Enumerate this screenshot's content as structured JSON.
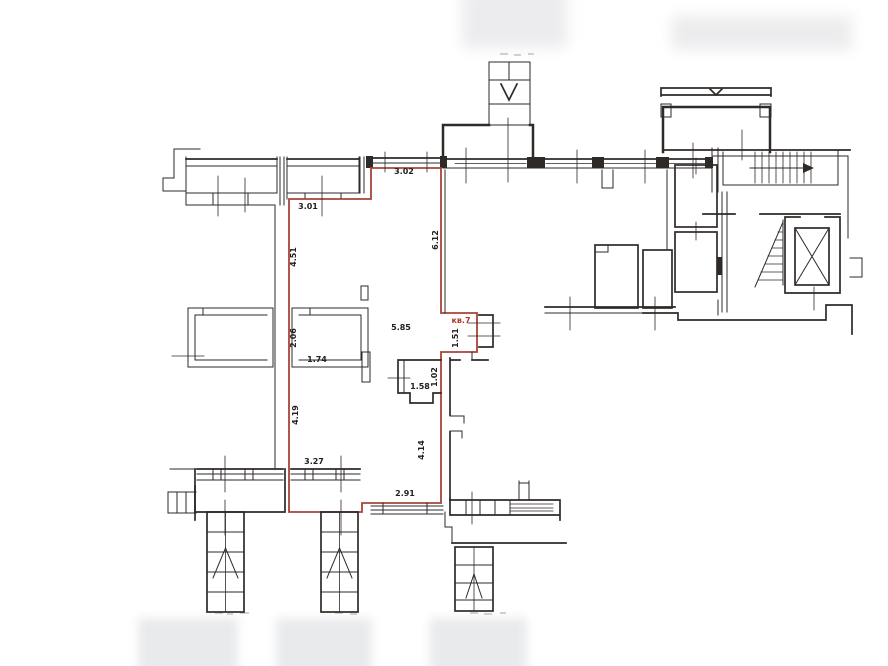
{
  "plan": {
    "apartment_label": "кв.7",
    "colors": {
      "walls": "#2e2a28",
      "apartment_outline": "#a84438",
      "apartment_label_color": "#b43527",
      "background": "#ffffff",
      "scan_artifact": "#ebecee"
    },
    "labels": [
      {
        "name": "dim-top-window",
        "text": "3.02",
        "x": 404,
        "y": 174,
        "rot": 0,
        "accent": false
      },
      {
        "name": "dim-upper-left-wall",
        "text": "3.01",
        "x": 308,
        "y": 209,
        "rot": 0,
        "accent": false
      },
      {
        "name": "dim-west-wall-upper",
        "text": "4.51",
        "x": 296,
        "y": 257,
        "rot": -90,
        "accent": false
      },
      {
        "name": "dim-east-wall",
        "text": "6.12",
        "x": 438,
        "y": 240,
        "rot": -90,
        "accent": false
      },
      {
        "name": "dim-room-width",
        "text": "5.85",
        "x": 401,
        "y": 330,
        "rot": 0,
        "accent": false
      },
      {
        "name": "apartment-number",
        "text": "кв.7",
        "x": 461,
        "y": 323,
        "rot": 0,
        "accent": true
      },
      {
        "name": "dim-entry-niche",
        "text": "1.51",
        "x": 458,
        "y": 338,
        "rot": -90,
        "accent": false
      },
      {
        "name": "dim-closet-depth",
        "text": "2.06",
        "x": 296,
        "y": 338,
        "rot": -90,
        "accent": false
      },
      {
        "name": "dim-closet-width",
        "text": "1.74",
        "x": 317,
        "y": 362,
        "rot": 0,
        "accent": false
      },
      {
        "name": "dim-bath-depth",
        "text": "1.02",
        "x": 437,
        "y": 377,
        "rot": -90,
        "accent": false
      },
      {
        "name": "dim-bath-width",
        "text": "1.58",
        "x": 420,
        "y": 389,
        "rot": 0,
        "accent": false
      },
      {
        "name": "dim-west-wall-lower",
        "text": "4.19",
        "x": 298,
        "y": 415,
        "rot": -90,
        "accent": false
      },
      {
        "name": "dim-east-wall-lower",
        "text": "4.14",
        "x": 424,
        "y": 450,
        "rot": -90,
        "accent": false
      },
      {
        "name": "dim-bottom-bay",
        "text": "3.27",
        "x": 314,
        "y": 464,
        "rot": 0,
        "accent": false
      },
      {
        "name": "dim-bottom-wall",
        "text": "2.91",
        "x": 405,
        "y": 496,
        "rot": 0,
        "accent": false
      }
    ]
  }
}
